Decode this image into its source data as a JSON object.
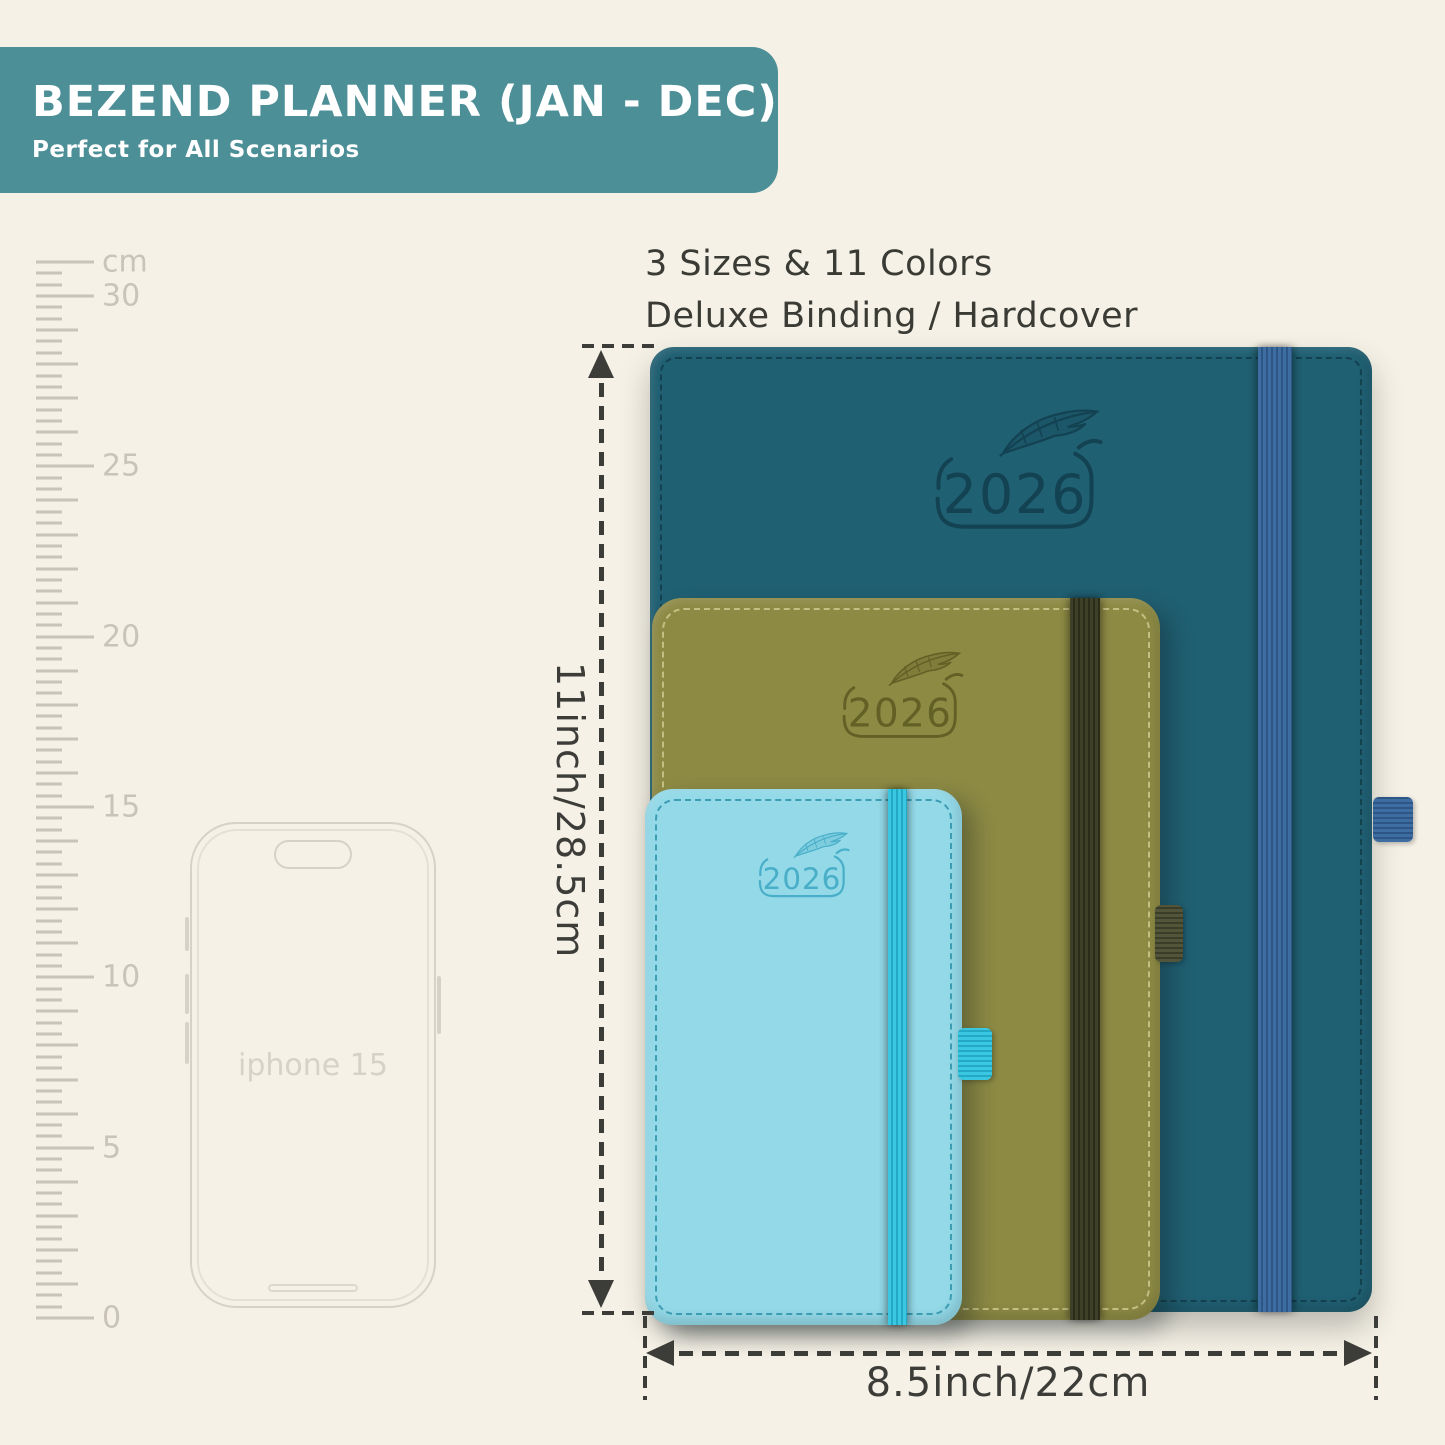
{
  "banner": {
    "title": "BEZEND PLANNER (JAN - DEC)",
    "subtitle": "Perfect for All Scenarios",
    "bg_color": "#4d8f97",
    "text_color": "#ffffff"
  },
  "features": {
    "line1": "3 Sizes & 11 Colors",
    "line2": "Deluxe Binding / Hardcover",
    "text_color": "#3b3b35"
  },
  "ruler": {
    "unit_label": "cm",
    "top_value": 31,
    "labeled_values": [
      0,
      5,
      10,
      15,
      20,
      25,
      30
    ],
    "ticks_per_cm": 3,
    "color": "#c9c4b9"
  },
  "phone": {
    "label": "iphone 15",
    "outline_color": "#d6d2c7"
  },
  "icons": {
    "emblem": "feather-quill-icon"
  },
  "planners": [
    {
      "size": "large",
      "year": "2026",
      "cover": "#206073",
      "emboss": "#123f4e",
      "stitch": "#123c49",
      "elastic": "#3e6da2",
      "elastic_shade": "#2d5687",
      "loop": "#3e6da2",
      "loop_shade": "#2d5687"
    },
    {
      "size": "medium",
      "year": "2026",
      "cover": "#8d8a44",
      "emboss": "#5e5b23",
      "stitch": "#cfc88f",
      "elastic": "#3e4028",
      "elastic_shade": "#2b2d1a",
      "loop": "#52553a",
      "loop_shade": "#3a3d27"
    },
    {
      "size": "small",
      "year": "2026",
      "cover": "#93d9e8",
      "emboss": "#3fa9c4",
      "stitch": "#2e93aa",
      "elastic": "#3ac7e1",
      "elastic_shade": "#23a9c4",
      "loop": "#3ac7e1",
      "loop_shade": "#23a9c4"
    }
  ],
  "dimensions": {
    "height_label": "11inch/28.5cm",
    "width_label": "8.5inch/22cm",
    "line_color": "#3c3c38"
  }
}
